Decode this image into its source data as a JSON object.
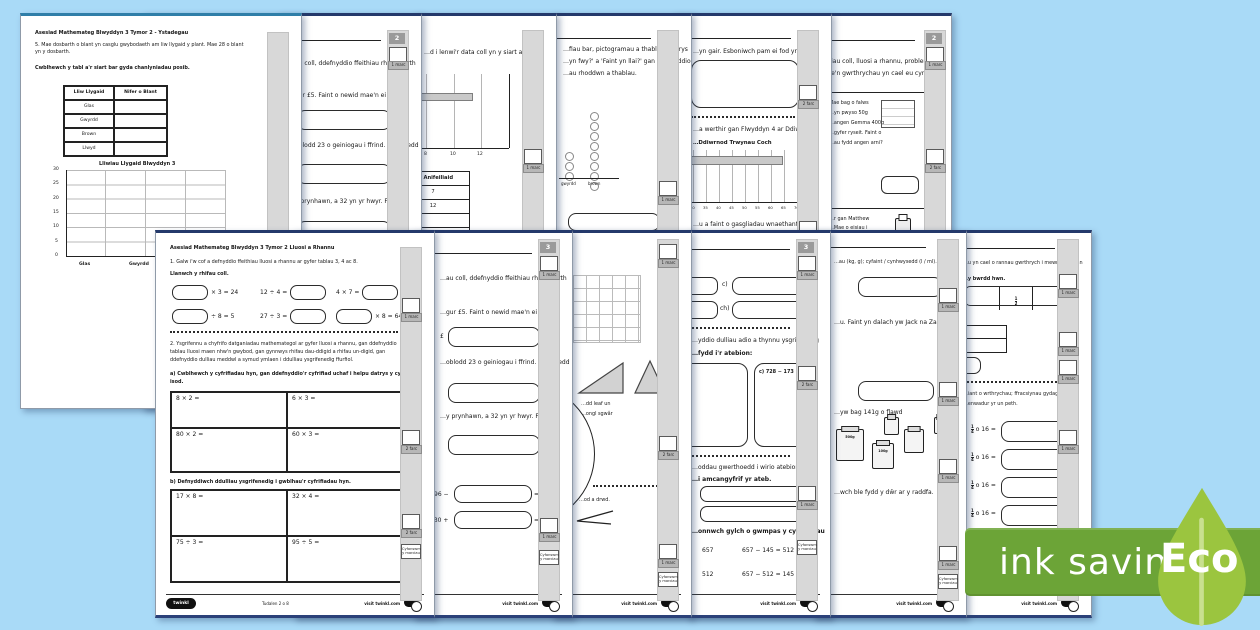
{
  "badge": {
    "ink_saving": "ink saving",
    "eco": "Eco",
    "banner_color": "#6CA437",
    "leaf_color": "#9BC53F"
  },
  "labels": {
    "marc1": "1 marc",
    "marc2": "2 farc",
    "cyf1": "Cyfanswm",
    "cyf2": "y marciau",
    "visit": "visit twinkl.com",
    "twinkl": "twinkl",
    "tudalen": "Tudalen 2 o 8"
  },
  "t1": {
    "header": "Asesiad Mathemateg Blwyddyn 3 Tymor 2 - Ystadegau",
    "q_line1": "5. Mae dosbarth o blant yn casglu gwybodaeth am liw llygaid y plant. Mae 28 o blant",
    "q_line2": "yn y dosbarth.",
    "instruction": "Cwblhewch y tabl a'r siart bar gyda chanlyniadau posib.",
    "table": {
      "h1": "Lliw Llygaid",
      "h2": "Nifer o Blant",
      "rows": [
        "Glas",
        "Gwyrdd",
        "Brown",
        "Llwyd"
      ]
    },
    "chart": {
      "title": "Lliwiau Llygaid Blwyddyn 3",
      "y_ticks": [
        "30",
        "25",
        "20",
        "15",
        "10",
        "5",
        "0"
      ],
      "x_labels": [
        "Glas",
        "Gwyrdd"
      ]
    }
  },
  "t2": {
    "page_no": "2",
    "l1": "…au coll, ddefnyddio ffeithiau rhif, gwerth",
    "l2": "…gur £5. Faint o newid mae'n ei gael?",
    "pound": "£",
    "l3": "…oblodd 23 o geiniogau i ffrind. Faint oedd",
    "l4": "…y prynhawn, a 32 yn yr hwyr. Faint o"
  },
  "t3": {
    "l1": "…d i lenwi'r data coll yn y siart a'r tabl",
    "ticks": [
      "8",
      "10",
      "12"
    ],
    "table_header": "…e Anifeiliaid",
    "cells": [
      "7",
      "12",
      "",
      "4"
    ]
  },
  "t4": {
    "l1": "…fiau bar, pictogramau a thablau. Datrys",
    "l2": "…yn fwy?' a 'Faint yn llai?' gan ddefnyddio",
    "l3": "…au rhoddwn a thablau.",
    "x_labels": [
      "gwyrdd",
      "brown"
    ]
  },
  "t5": {
    "l1": "…yn gair. Esboniwch pam ei fod yn",
    "l2": "…a werthir gan Flwyddyn 4 ar Ddiwrnod",
    "chart_title": "…Ddiwrnod Trwynau Coch",
    "ticks": [
      "30",
      "35",
      "40",
      "45",
      "50",
      "55",
      "60",
      "65",
      "70"
    ],
    "l3": "…u a faint o gasgliadau wnaethant eu"
  },
  "t6": {
    "page_no": "2",
    "l1": "…fiau coll, lluosi a rhannu, problemau",
    "l2": "…fe'n gwrthrychau yn cael eu cynllunio",
    "box1": [
      "Mae bag o falws",
      "…yn pwyso 50g",
      "…angen Gemma 400g",
      "…gyfer ryseit. Faint o",
      "…au fydd angen arni?"
    ],
    "box2": [
      "…r gan Matthew",
      "…Mae o eisiau i",
      "…u 3 potel am 12c",
      "…Gyda gweddill ei",
      "…mae eisiau prynu",
      "…n costio 6c yr",
      "…Faint o boteli bydd",
      "…thew yn prynu?"
    ]
  },
  "b1": {
    "header": "Asesiad Mathemateg Blwyddyn 3 Tymor 2 Lluosi a Rhannu",
    "q1": "1. Galw i'w cof a defnyddio ffeithiau lluosi a rhannu ar gyfer tablau 3, 4 ac 8.",
    "inst1": "Llanwch y rhifau coll.",
    "eq": {
      "e1": "× 3 = 24",
      "e2": "12 ÷ 4 =",
      "e3": "4 × 7 =",
      "e4": "÷ 8 = 5",
      "e5": "27 ÷ 3 =",
      "e6": "× 8 = 64"
    },
    "q2_line1": "2. Ysgrifennu a chyfrifo datganiadau mathemategol ar gyfer lluosi a rhannu, gan ddefnyddio",
    "q2_line2": "tablau lluosi maen nhw'n gwybod, gan gynnwys rhifau dau-ddigid a rhifau un-digid, gan",
    "q2_line3": "ddefnyddio dulliau meddwl a symud ymlaen i ddulliau ysgrifenedig ffurfiol.",
    "inst_a1": "a) Cwblhewch y cyfrifiadau hyn, gan ddefnyddio'r cyfrifiad uchaf i helpu datrys y cyfrifiad",
    "inst_a2": "isod.",
    "table_a": [
      "8 × 2 =",
      "6 × 3 =",
      "80 × 2 =",
      "60 × 3 ="
    ],
    "inst_b": "b) Defnyddiwch ddulliau ysgrifenedig i gwblhau'r cyfrifiadau hyn.",
    "table_b": [
      "17 × 8 =",
      "32 × 4 =",
      "75 ÷ 3 =",
      "95 ÷ 5 ="
    ]
  },
  "b2": {
    "page_no": "3",
    "l1": "…au coll, ddefnyddio ffeithiau rhif, gwerth",
    "l2": "…gur £5. Faint o newid mae'n ei gael?",
    "pound": "£",
    "l3": "…oblodd 23 o geiniogau i ffrind. Faint oedd",
    "l4": "…y prynhawn, a 32 yn yr hwyr. Faint o",
    "e1_pre": "96 −",
    "e1_post": "= 29",
    "e2_pre": "430 +",
    "e2_post": "= 342"
  },
  "b3": {
    "f1": "…dd leaf un",
    "f2": "…ongl sgwâr",
    "f3": "…od a drwd."
  },
  "b4": {
    "page_no": "3",
    "c": "c)",
    "ch": "ch)",
    "l1": "…yddio dulliau adio a thynnu ysgrifenedig",
    "h1": "…fydd i'r atebion:",
    "box_label": "c) 728 − 173 =",
    "l2": "…oddau gwerthoedd i wirio atebion.",
    "h2": "…i amcangyfrif yr ateb.",
    "h3": "…onnwch gylch o gwmpas y cyfrifiadau",
    "eq1a": "657",
    "eq1b": "657 − 145 = 512",
    "eq2a": "512",
    "eq2b": "657 − 512 = 145"
  },
  "b5": {
    "l1": "…au (kg, g); cyfaint / cynhwysedd (l / ml).",
    "l2": "…u. Faint yn dalach yw Jack na Zack?",
    "cm": "cm",
    "l3": "…yw bag 141g o flawd",
    "jar_labels": [
      "500g",
      "100g"
    ],
    "l4": "…wch ble fydd y dŵr ar y raddfa."
  },
  "b6": {
    "l1": "…u yn cael o rannau gwrthrych i mewn i 10 rhan",
    "h1": "…y bwrdd hwn.",
    "frac_n": "1",
    "frac_d": "2",
    "l2": "…iant o wrthrychau; ffracsiynau gydag un",
    "l3": "…enwadur yr un peth.",
    "row_frac_n": "1",
    "row_frac_d": "4",
    "row_text": "o 16 ="
  }
}
